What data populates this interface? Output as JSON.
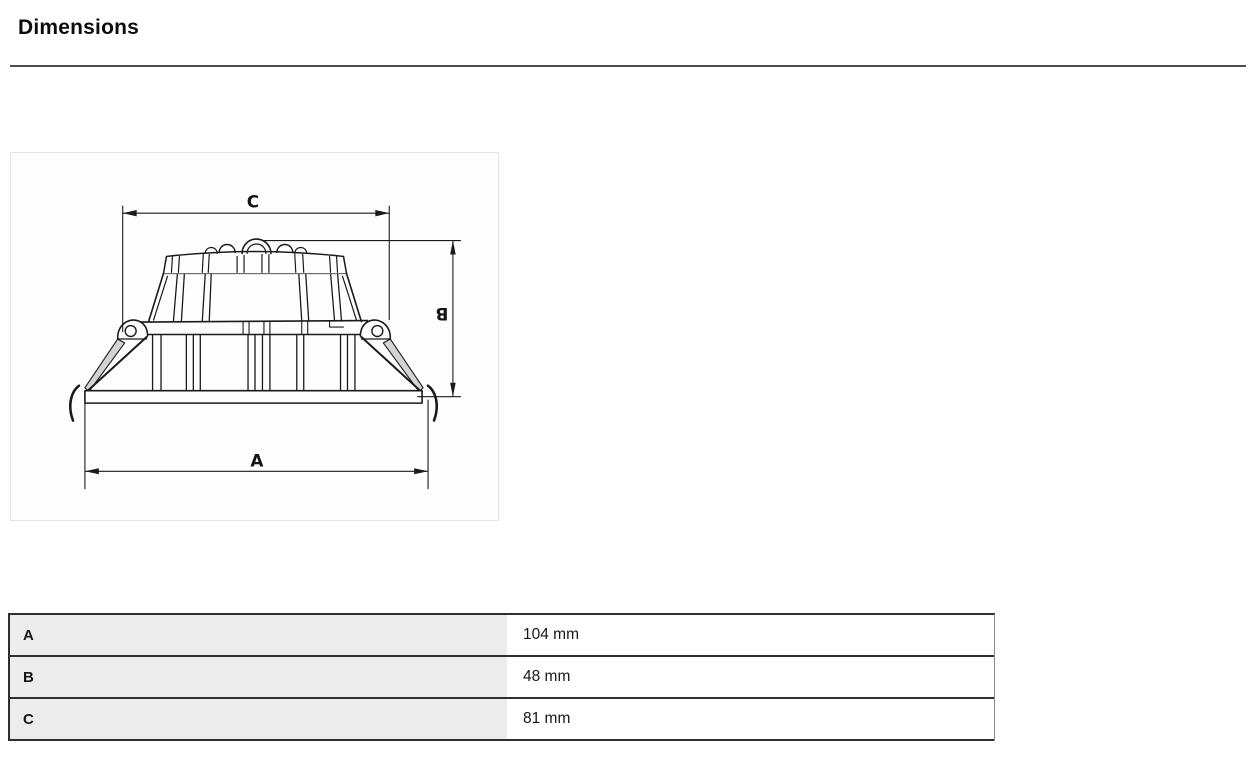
{
  "page": {
    "title": "Dimensions"
  },
  "diagram": {
    "description": "Side-view technical sketch of a recessed LED downlight with spring clips",
    "labels": {
      "a": "A",
      "b": "B",
      "c": "C"
    }
  },
  "table": {
    "rows": [
      {
        "label": "A",
        "value": "104 mm"
      },
      {
        "label": "B",
        "value": "48 mm"
      },
      {
        "label": "C",
        "value": "81 mm"
      }
    ]
  },
  "colors": {
    "drawing_stroke": "#1a1a1a",
    "table_key_bg": "#ececec",
    "table_border": "#2f2f2f",
    "rule": "#4e4e4e",
    "diagram_box_border": "#e4e4e4"
  }
}
